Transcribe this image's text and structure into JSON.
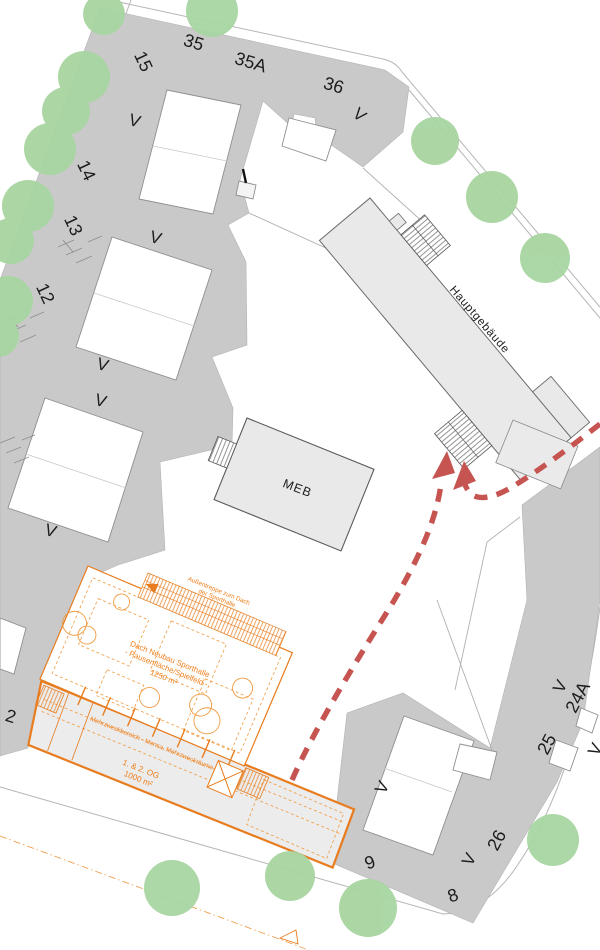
{
  "labels": {
    "h15": "15",
    "h35": "35",
    "h35a": "35A",
    "h36": "36",
    "h14": "14",
    "h13": "13",
    "h12": "12",
    "h2": "2",
    "h9": "9",
    "h8": "8",
    "h26": "26",
    "h25": "25",
    "h24a": "24A",
    "v": "V",
    "hauptgebaeude": "Hauptgebäude",
    "meb": "MEB"
  },
  "sporthalle": {
    "stair_note_line1": "Außentreppe zum Dach",
    "stair_note_line2": "der Sporthalle",
    "roof_line1": "Dach Neubau Sporthalle",
    "roof_line2": "- Pausenfläche/Spielfeld -",
    "roof_line3": "1250 m²",
    "band_label": "Mehrzweckbereich - Mensa, Mehrzweckräume",
    "og_line1": "1. & 2. OG",
    "og_line2": "1000 m²"
  },
  "colors": {
    "block_gray": "#c9c9c9",
    "building_gray": "#e9e9e9",
    "tree_green": "#a8d5a1",
    "accent_orange": "#e87c1e",
    "orange_text": "#ee7f1c",
    "route_red": "#c65450",
    "street_line_gray": "#b5b5b5"
  }
}
